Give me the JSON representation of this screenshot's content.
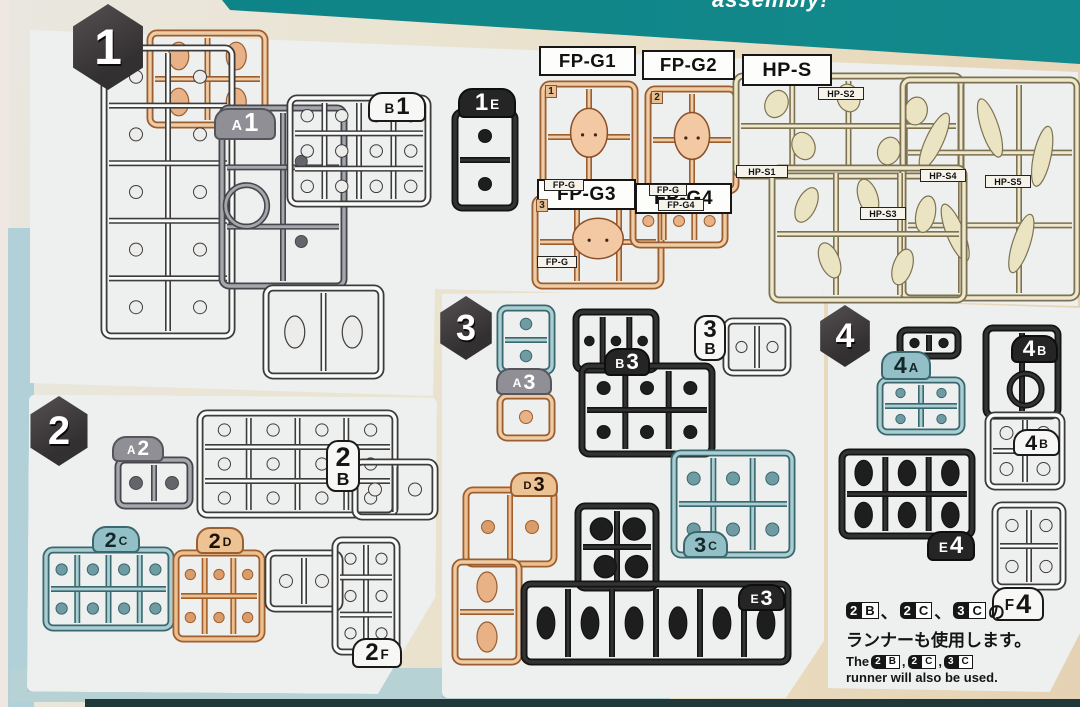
{
  "header": {
    "partial_text": "assembly!"
  },
  "colors": {
    "band": "#0e8386",
    "panel": "#eef0ef",
    "badge_bg": "#333031",
    "badge_text": "#ffffff",
    "plastics": {
      "tan": {
        "fill": "#f0cba3",
        "line": "#995e31",
        "part": "#e8b286"
      },
      "tan2": {
        "fill": "#eec091",
        "line": "#a05f2d",
        "part": "#d99c6b"
      },
      "cream": {
        "fill": "#efe8cd",
        "line": "#7c7251",
        "part": "#e7dfbc"
      },
      "white": {
        "fill": "#fbfbfa",
        "line": "#3c3c3c",
        "part": "#ececea"
      },
      "gray": {
        "fill": "#a6a6ad",
        "line": "#46464c",
        "part": "#64646b"
      },
      "black": {
        "fill": "#333333",
        "line": "#141414",
        "part": "#1e1e1e"
      },
      "teal": {
        "fill": "#abced3",
        "line": "#3a686f",
        "part": "#6f9ca3"
      }
    },
    "tag_styles": {
      "gray": {
        "bg": "#8f8f95",
        "fg": "#ffffff",
        "border": "#55555b"
      },
      "white": {
        "bg": "#f7f7f5",
        "fg": "#151515",
        "border": "#1a1a1a"
      },
      "black": {
        "bg": "#262525",
        "fg": "#ffffff",
        "border": "#0e0e0e"
      },
      "teal": {
        "bg": "#93c0c6",
        "fg": "#14282c",
        "border": "#3a686f"
      },
      "tan": {
        "bg": "#eec394",
        "fg": "#1d1208",
        "border": "#9a5f33"
      }
    }
  },
  "section_badges": [
    {
      "id": "s1",
      "num": "1"
    },
    {
      "id": "s2",
      "num": "2"
    },
    {
      "id": "s3",
      "num": "3"
    },
    {
      "id": "s4",
      "num": "4"
    }
  ],
  "part_labels": [
    {
      "id": "fp_g1",
      "text": "FP-G1"
    },
    {
      "id": "fp_g2",
      "text": "FP-G2"
    },
    {
      "id": "hp_s",
      "text": "HP-S"
    },
    {
      "id": "fp_g3",
      "text": "FP-G3"
    },
    {
      "id": "fp_g4",
      "text": "FP-G4"
    }
  ],
  "sub_labels": [
    {
      "id": "hp_s1",
      "text": "HP-S1"
    },
    {
      "id": "hp_s2",
      "text": "HP-S2"
    },
    {
      "id": "hp_s3",
      "text": "HP-S3"
    },
    {
      "id": "hp_s4",
      "text": "HP-S4"
    },
    {
      "id": "hp_s5",
      "text": "HP-S5"
    },
    {
      "id": "fpg_t1",
      "text": "FP-G"
    },
    {
      "id": "fpg_t2",
      "text": "FP-G"
    },
    {
      "id": "fpg_t3",
      "text": "FP-G"
    },
    {
      "id": "fpg_t4",
      "text": "FP-G4"
    }
  ],
  "corner_nums": [
    {
      "id": "n1",
      "text": "1"
    },
    {
      "id": "n2",
      "text": "2"
    },
    {
      "id": "n3",
      "text": "3"
    }
  ],
  "runner_tags": [
    {
      "id": "t_a1",
      "chars": [
        {
          "t": "A",
          "big": false
        },
        {
          "t": "1",
          "big": true
        }
      ],
      "style": "gray",
      "layout": "h"
    },
    {
      "id": "t_b1",
      "chars": [
        {
          "t": "B",
          "big": false
        },
        {
          "t": "1",
          "big": true
        }
      ],
      "style": "white",
      "layout": "h"
    },
    {
      "id": "t_1e",
      "chars": [
        {
          "t": "1",
          "big": true
        },
        {
          "t": "E",
          "big": false
        }
      ],
      "style": "black",
      "layout": "h"
    },
    {
      "id": "t_a2",
      "chars": [
        {
          "t": "A",
          "big": false
        },
        {
          "t": "2",
          "big": true
        }
      ],
      "style": "gray",
      "layout": "h"
    },
    {
      "id": "t_2b",
      "chars": [
        {
          "t": "2",
          "big": true
        },
        {
          "t": "B",
          "big": false
        }
      ],
      "style": "white",
      "layout": "v"
    },
    {
      "id": "t_2c",
      "chars": [
        {
          "t": "2",
          "big": true
        },
        {
          "t": "C",
          "big": false
        }
      ],
      "style": "teal",
      "layout": "h"
    },
    {
      "id": "t_2d",
      "chars": [
        {
          "t": "2",
          "big": true
        },
        {
          "t": "D",
          "big": false
        }
      ],
      "style": "tan",
      "layout": "h"
    },
    {
      "id": "t_2f",
      "chars": [
        {
          "t": "2",
          "big": true
        },
        {
          "t": "F",
          "big": false
        }
      ],
      "style": "white",
      "layout": "h"
    },
    {
      "id": "t_a3",
      "chars": [
        {
          "t": "A",
          "big": false
        },
        {
          "t": "3",
          "big": true
        }
      ],
      "style": "gray",
      "layout": "h"
    },
    {
      "id": "t_b3",
      "chars": [
        {
          "t": "B",
          "big": false
        },
        {
          "t": "3",
          "big": true
        }
      ],
      "style": "black",
      "layout": "h"
    },
    {
      "id": "t_3b",
      "chars": [
        {
          "t": "3",
          "big": true
        },
        {
          "t": "B",
          "big": false
        }
      ],
      "style": "white",
      "layout": "v"
    },
    {
      "id": "t_d3",
      "chars": [
        {
          "t": "D",
          "big": false
        },
        {
          "t": "3",
          "big": true
        }
      ],
      "style": "tan",
      "layout": "h"
    },
    {
      "id": "t_3c",
      "chars": [
        {
          "t": "3",
          "big": true
        },
        {
          "t": "C",
          "big": false
        }
      ],
      "style": "teal",
      "layout": "h"
    },
    {
      "id": "t_e3",
      "chars": [
        {
          "t": "E",
          "big": false
        },
        {
          "t": "3",
          "big": true
        }
      ],
      "style": "black",
      "layout": "h"
    },
    {
      "id": "t_4a",
      "chars": [
        {
          "t": "4",
          "big": true
        },
        {
          "t": "A",
          "big": false
        }
      ],
      "style": "teal",
      "layout": "h"
    },
    {
      "id": "t_4b_blk",
      "chars": [
        {
          "t": "4",
          "big": true
        },
        {
          "t": "B",
          "big": false
        }
      ],
      "style": "black",
      "layout": "h"
    },
    {
      "id": "t_4b_wht",
      "chars": [
        {
          "t": "4",
          "big": true
        },
        {
          "t": "B",
          "big": false
        }
      ],
      "style": "white",
      "layout": "h"
    },
    {
      "id": "t_e4",
      "chars": [
        {
          "t": "E",
          "big": false
        },
        {
          "t": "4",
          "big": true
        }
      ],
      "style": "black",
      "layout": "h"
    },
    {
      "id": "t_f4",
      "chars": [
        {
          "t": "F",
          "big": false
        },
        {
          "t": "4",
          "big": true
        }
      ],
      "style": "white",
      "layout": "h"
    }
  ],
  "runners": [
    {
      "id": "a1_tan",
      "color": "tan",
      "motif": "blobs"
    },
    {
      "id": "a1_white",
      "color": "white",
      "motif": "circles"
    },
    {
      "id": "a1_gray",
      "color": "gray",
      "motif": "ring"
    },
    {
      "id": "a1_skirt",
      "color": "white",
      "motif": "blobs"
    },
    {
      "id": "b1",
      "color": "white",
      "motif": "circles"
    },
    {
      "id": "e1",
      "color": "black",
      "motif": "circles"
    },
    {
      "id": "fpg1",
      "color": "tan",
      "motif": "face"
    },
    {
      "id": "fpg2",
      "color": "tan",
      "motif": "face"
    },
    {
      "id": "fpg3",
      "color": "tan",
      "motif": "face"
    },
    {
      "id": "fpg4",
      "color": "tan",
      "motif": "circles"
    },
    {
      "id": "hp_a",
      "color": "cream",
      "motif": "hair"
    },
    {
      "id": "hp_b",
      "color": "cream",
      "motif": "hair"
    },
    {
      "id": "hp_c",
      "color": "cream",
      "motif": "hair"
    },
    {
      "id": "a2",
      "color": "gray",
      "motif": "circles"
    },
    {
      "id": "b2",
      "color": "white",
      "motif": "circles"
    },
    {
      "id": "b2_ext",
      "color": "white",
      "motif": "circles"
    },
    {
      "id": "c2",
      "color": "teal",
      "motif": "circles"
    },
    {
      "id": "d2",
      "color": "tan2",
      "motif": "circles"
    },
    {
      "id": "f2a",
      "color": "white",
      "motif": "circles"
    },
    {
      "id": "f2b",
      "color": "white",
      "motif": "circles"
    },
    {
      "id": "a3_teal",
      "color": "teal",
      "motif": "circles"
    },
    {
      "id": "a3_tan",
      "color": "tan",
      "motif": "circles"
    },
    {
      "id": "b3_up",
      "color": "black",
      "motif": "circles"
    },
    {
      "id": "b3_low",
      "color": "black",
      "motif": "circles"
    },
    {
      "id": "b3_3b",
      "color": "white",
      "motif": "circles"
    },
    {
      "id": "d3_up",
      "color": "tan2",
      "motif": "circles"
    },
    {
      "id": "d3_low",
      "color": "tan",
      "motif": "blobs"
    },
    {
      "id": "c3_mid",
      "color": "black",
      "motif": "bigdots"
    },
    {
      "id": "e3",
      "color": "black",
      "motif": "blobs"
    },
    {
      "id": "c3_teal",
      "color": "teal",
      "motif": "circles"
    },
    {
      "id": "a4_top",
      "color": "black",
      "motif": "circles"
    },
    {
      "id": "a4",
      "color": "teal",
      "motif": "circles"
    },
    {
      "id": "b4_blk",
      "color": "black",
      "motif": "ringlow"
    },
    {
      "id": "b4_wht",
      "color": "white",
      "motif": "circles"
    },
    {
      "id": "e4",
      "color": "black",
      "motif": "blobs"
    },
    {
      "id": "f4",
      "color": "white",
      "motif": "circles"
    }
  ],
  "note": {
    "items": [
      {
        "num": "2",
        "letter": "B"
      },
      {
        "num": "2",
        "letter": "C"
      },
      {
        "num": "3",
        "letter": "C"
      }
    ],
    "jp_separator": "、",
    "jp_line1_suffix": "の",
    "jp_line2": "ランナーも使用します。",
    "en_prefix": "The",
    "en_separator": ",",
    "en_line2": "runner will also be used."
  }
}
